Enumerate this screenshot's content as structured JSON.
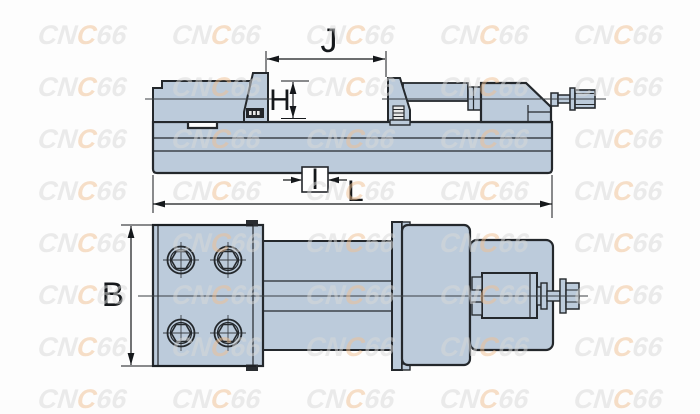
{
  "colors": {
    "background": "#fdfdfd",
    "body_fill": "#bccbdb",
    "outline": "#24282c",
    "thin_line": "#3a3f44",
    "dimension_line": "#15181b",
    "label_text": "#101214",
    "watermark_gray": "#d9d9d9",
    "watermark_accent": "#f0c092"
  },
  "dimension_labels": {
    "jaw_opening": "J",
    "jaw_height": "H",
    "key_slot_width": "I",
    "overall_length": "L",
    "body_width": "B"
  },
  "watermark": {
    "text": "CNC66",
    "segments": [
      {
        "text": "CN",
        "color_key": "gray"
      },
      {
        "text": "C",
        "color_key": "accent"
      },
      {
        "text": "66",
        "color_key": "gray"
      }
    ],
    "columns_x": [
      38,
      172,
      306,
      440,
      574
    ],
    "rows_y": [
      28,
      80,
      132,
      184,
      236,
      288,
      340,
      392
    ]
  }
}
